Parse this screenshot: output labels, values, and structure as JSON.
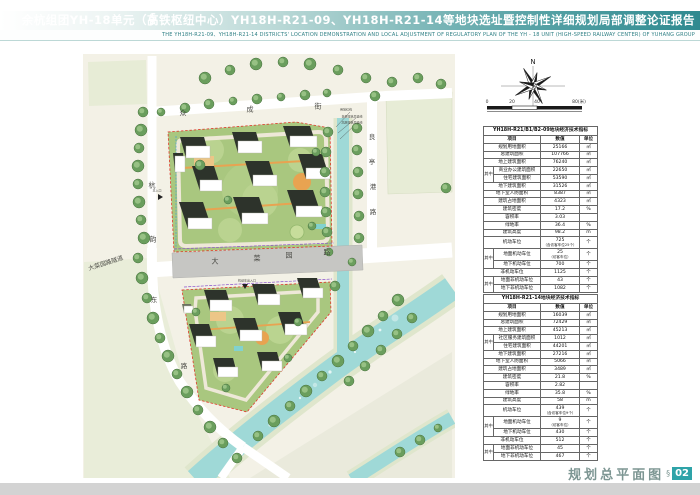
{
  "header": {
    "logo_glyph": "§",
    "title_cn": "余杭组团YH-18单元（高铁枢纽中心）YH18H-R21-09、YH18H-R21-14等地块选址暨控制性详细规划局部调整论证报告",
    "title_en": "THE YH18H-R21-09、YH18H-R21-14 DISTRICTS' LOCATION DEMONSTRATION AND LOCAL ADJUSTMENT OF REGULATORY PLAN  OF THE YH - 18 UNIT (HIGH-SPEED RAILWAY CENTER)  OF YUHANG GROUP"
  },
  "map": {
    "compass_label": "N",
    "scale_ticks": [
      "0",
      "20",
      "40",
      "80(米)"
    ],
    "labels": [
      {
        "text": "众",
        "x": 183,
        "y": 114,
        "size": 7
      },
      {
        "text": "成",
        "x": 250,
        "y": 110,
        "size": 7
      },
      {
        "text": "街",
        "x": 318,
        "y": 107,
        "size": 7
      },
      {
        "text": "杭",
        "x": 152,
        "y": 186,
        "size": 7
      },
      {
        "text": "韵",
        "x": 153,
        "y": 240,
        "size": 7
      },
      {
        "text": "良",
        "x": 372,
        "y": 137,
        "size": 6.5
      },
      {
        "text": "亭",
        "x": 372,
        "y": 162,
        "size": 6.5
      },
      {
        "text": "港",
        "x": 373,
        "y": 187,
        "size": 6.5
      },
      {
        "text": "路",
        "x": 373,
        "y": 212,
        "size": 6.5
      },
      {
        "text": "大",
        "x": 215,
        "y": 262,
        "size": 7
      },
      {
        "text": "菜",
        "x": 257,
        "y": 259,
        "size": 7
      },
      {
        "text": "园",
        "x": 289,
        "y": 256,
        "size": 7
      },
      {
        "text": "路",
        "x": 327,
        "y": 253,
        "size": 7
      },
      {
        "text": "大菜园路隧道",
        "x": 106,
        "y": 264,
        "size": 6,
        "rot": -18
      },
      {
        "text": "东",
        "x": 154,
        "y": 300,
        "size": 6.5
      },
      {
        "text": "路",
        "x": 184,
        "y": 366,
        "size": 6.5
      },
      {
        "text": "用地红线",
        "x": 346,
        "y": 110,
        "size": 3
      },
      {
        "text": "多层建筑后退线",
        "x": 352,
        "y": 117,
        "size": 3
      },
      {
        "text": "高层建筑后退线",
        "x": 352,
        "y": 123,
        "size": 3
      },
      {
        "text": "主入口",
        "x": 157,
        "y": 191,
        "size": 3
      },
      {
        "text": "机动车出入口",
        "x": 247,
        "y": 281,
        "size": 3
      }
    ]
  },
  "tables": [
    {
      "title": "YH18H-R21/B1/B2-09地块经济技术指标",
      "columns": [
        "项目",
        "数值",
        "单位"
      ],
      "rows": [
        {
          "label": "规划用地面积",
          "value": "25166",
          "unit": "㎡"
        },
        {
          "label": "总建筑面积",
          "value": "107766",
          "unit": "㎡"
        },
        {
          "label": "地上建筑面积",
          "value": "76240",
          "unit": "㎡"
        },
        {
          "label": "商业办公建筑面积",
          "value": "22650",
          "unit": "㎡",
          "gid": 1,
          "glabel": "其中"
        },
        {
          "label": "住宅建筑面积",
          "value": "53590",
          "unit": "㎡",
          "gid": 1,
          "glabel": "其中"
        },
        {
          "label": "地下建筑面积",
          "value": "31526",
          "unit": "㎡"
        },
        {
          "label": "地下室人防面积",
          "value": "8387",
          "unit": "㎡"
        },
        {
          "label": "建筑占地面积",
          "value": "4323",
          "unit": "㎡"
        },
        {
          "label": "建筑密度",
          "value": "17.2",
          "unit": "%"
        },
        {
          "label": "容积率",
          "value": "3.03",
          "unit": ""
        },
        {
          "label": "绿地率",
          "value": "36.4",
          "unit": "%"
        },
        {
          "label": "建筑高度",
          "value": "98.2",
          "unit": "m"
        },
        {
          "label": "机动车位",
          "value": "725",
          "note": "（含访客车位25个）",
          "unit": "个"
        },
        {
          "label": "地面机动车位",
          "value": "25",
          "note": "（访客车位）",
          "unit": "个",
          "gid": 2,
          "glabel": "其中"
        },
        {
          "label": "地下机动车位",
          "value": "700",
          "unit": "个",
          "gid": 2,
          "glabel": "其中"
        },
        {
          "label": "非机动车位",
          "value": "1125",
          "unit": "个"
        },
        {
          "label": "地面非机动车位",
          "value": "43",
          "unit": "个",
          "gid": 3,
          "glabel": "其中"
        },
        {
          "label": "地下非机动车位",
          "value": "1082",
          "unit": "个",
          "gid": 3,
          "glabel": "其中"
        }
      ]
    },
    {
      "title": "YH18H-R21-14地块经济技术指标",
      "columns": [
        "项目",
        "数值",
        "单位"
      ],
      "rows": [
        {
          "label": "规划用地面积",
          "value": "16039",
          "unit": "㎡"
        },
        {
          "label": "总建筑面积",
          "value": "72429",
          "unit": "㎡"
        },
        {
          "label": "地上建筑面积",
          "value": "45213",
          "unit": "㎡"
        },
        {
          "label": "社区服务建筑面积",
          "value": "1012",
          "unit": "㎡",
          "gid": 1,
          "glabel": "其中"
        },
        {
          "label": "住宅建筑面积",
          "value": "44201",
          "unit": "㎡",
          "gid": 1,
          "glabel": "其中"
        },
        {
          "label": "地下建筑面积",
          "value": "27216",
          "unit": "㎡"
        },
        {
          "label": "地下室人防面积",
          "value": "5066",
          "unit": "㎡"
        },
        {
          "label": "建筑占地面积",
          "value": "3489",
          "unit": "㎡"
        },
        {
          "label": "建筑密度",
          "value": "21.8",
          "unit": "%"
        },
        {
          "label": "容积率",
          "value": "2.82",
          "unit": ""
        },
        {
          "label": "绿地率",
          "value": "35.8",
          "unit": "%"
        },
        {
          "label": "建筑高度",
          "value": "58",
          "unit": "m"
        },
        {
          "label": "机动车位",
          "value": "439",
          "note": "（含访客车位9个）",
          "unit": "个"
        },
        {
          "label": "地面机动车位",
          "value": "9",
          "note": "（访客车位）",
          "unit": "个",
          "gid": 2,
          "glabel": "其中"
        },
        {
          "label": "地下机动车位",
          "value": "430",
          "unit": "个",
          "gid": 2,
          "glabel": "其中"
        },
        {
          "label": "非机动车位",
          "value": "512",
          "unit": "个"
        },
        {
          "label": "地面非机动车位",
          "value": "45",
          "unit": "个",
          "gid": 3,
          "glabel": "其中"
        },
        {
          "label": "地下非机动车位",
          "value": "467",
          "unit": "个",
          "gid": 3,
          "glabel": "其中"
        }
      ]
    }
  ],
  "footer": {
    "title": "规划总平面图",
    "section_mark": "§",
    "page_number": "02"
  },
  "colors": {
    "accent_teal": "#2f8a90",
    "footer_page_box": "#2ea3a8",
    "water": "#9fd9d7",
    "site_green": "#a9c77f",
    "road_gray": "#c6c6c3",
    "bottom_band": "#d3d3d3",
    "boundary_red": "#e0392b"
  }
}
